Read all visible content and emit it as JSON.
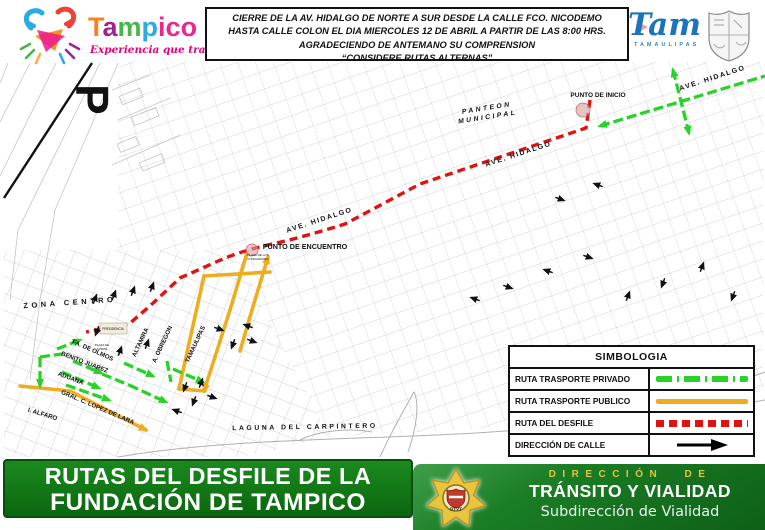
{
  "header": {
    "tampico": {
      "t": "T",
      "a": "a",
      "m": "m",
      "p": "p",
      "ico": "ico",
      "tagline": "Experiencia que transforma"
    },
    "notice": {
      "line1": "CIERRE DE LA AV. HIDALGO DE NORTE A SUR DESDE LA CALLE FCO. NICODEMO",
      "line2": "HASTA CALLE COLON EL DIA MIERCOLES 12 DE ABRIL A PARTIR DE LAS 8:00 HRS.",
      "line3": "AGRADECIENDO DE ANTEMANO SU COMPRENSION",
      "line4": "“CONSIDERE RUTAS ALTERNAS”"
    },
    "tam": {
      "word": "Tam",
      "subtitle": "TAMAULIPAS"
    }
  },
  "map": {
    "labels": {
      "p_marker": "P",
      "punto_inicio": "PUNTO DE INICIO",
      "punto_encuentro": "PUNTO DE ENCUENTRO",
      "panteon_line1": "PANTEON",
      "panteon_line2": "MUNICIPAL",
      "ave_hidalgo": "AVE. HIDALGO",
      "zona_centro": "ZONA CENTRO",
      "laguna": "LAGUNA DEL CARPINTERO",
      "fa_de_olmos": "FA. DE OLMOS",
      "benito_juarez": "BENITO JUAREZ",
      "aduana": "ADUANA",
      "lopez_de_lara": "GRAL. C. LOPEZ DE LARA",
      "alfaro": "I. ALFARO",
      "altamira": "ALTAMIRA",
      "obregon": "A. OBREGON",
      "tamaulipas": "TAMAULIPAS",
      "presidencia": "PRESIDENCIA",
      "plaza_armas_1": "PLAZA DE",
      "plaza_armas_2": "ARMAS",
      "plaza_enc_1": "PLAZA DE LOS",
      "plaza_enc_2": "FUNDADORES"
    },
    "route_colors": {
      "desfile": "#e01212",
      "privado": "#28d228",
      "publico": "#eead1f"
    }
  },
  "legend": {
    "title": "SIMBOLOGIA",
    "rows": [
      {
        "label": "RUTA TRASPORTE PRIVADO",
        "symbol": "green-dashed-line"
      },
      {
        "label": "RUTA TRASPORTE PUBLICO",
        "symbol": "yellow-solid-line"
      },
      {
        "label": "RUTA DEL DESFILE",
        "symbol": "red-dashed-line"
      },
      {
        "label": "DIRECCIÓN DE CALLE",
        "symbol": "black-arrow"
      }
    ]
  },
  "footer": {
    "banner_line1": "RUTAS DEL DESFILE DE LA",
    "banner_line2": "FUNDACIÓN DE TAMPICO",
    "dept_line1": "DIRECCIÓN DE",
    "dept_line2": "TRÁNSITO Y VIALIDAD",
    "dept_line3": "Subdirección de Vialidad",
    "badge": "DTVT",
    "banner_green": "#0f7a12",
    "gold": "#e3c43c"
  }
}
